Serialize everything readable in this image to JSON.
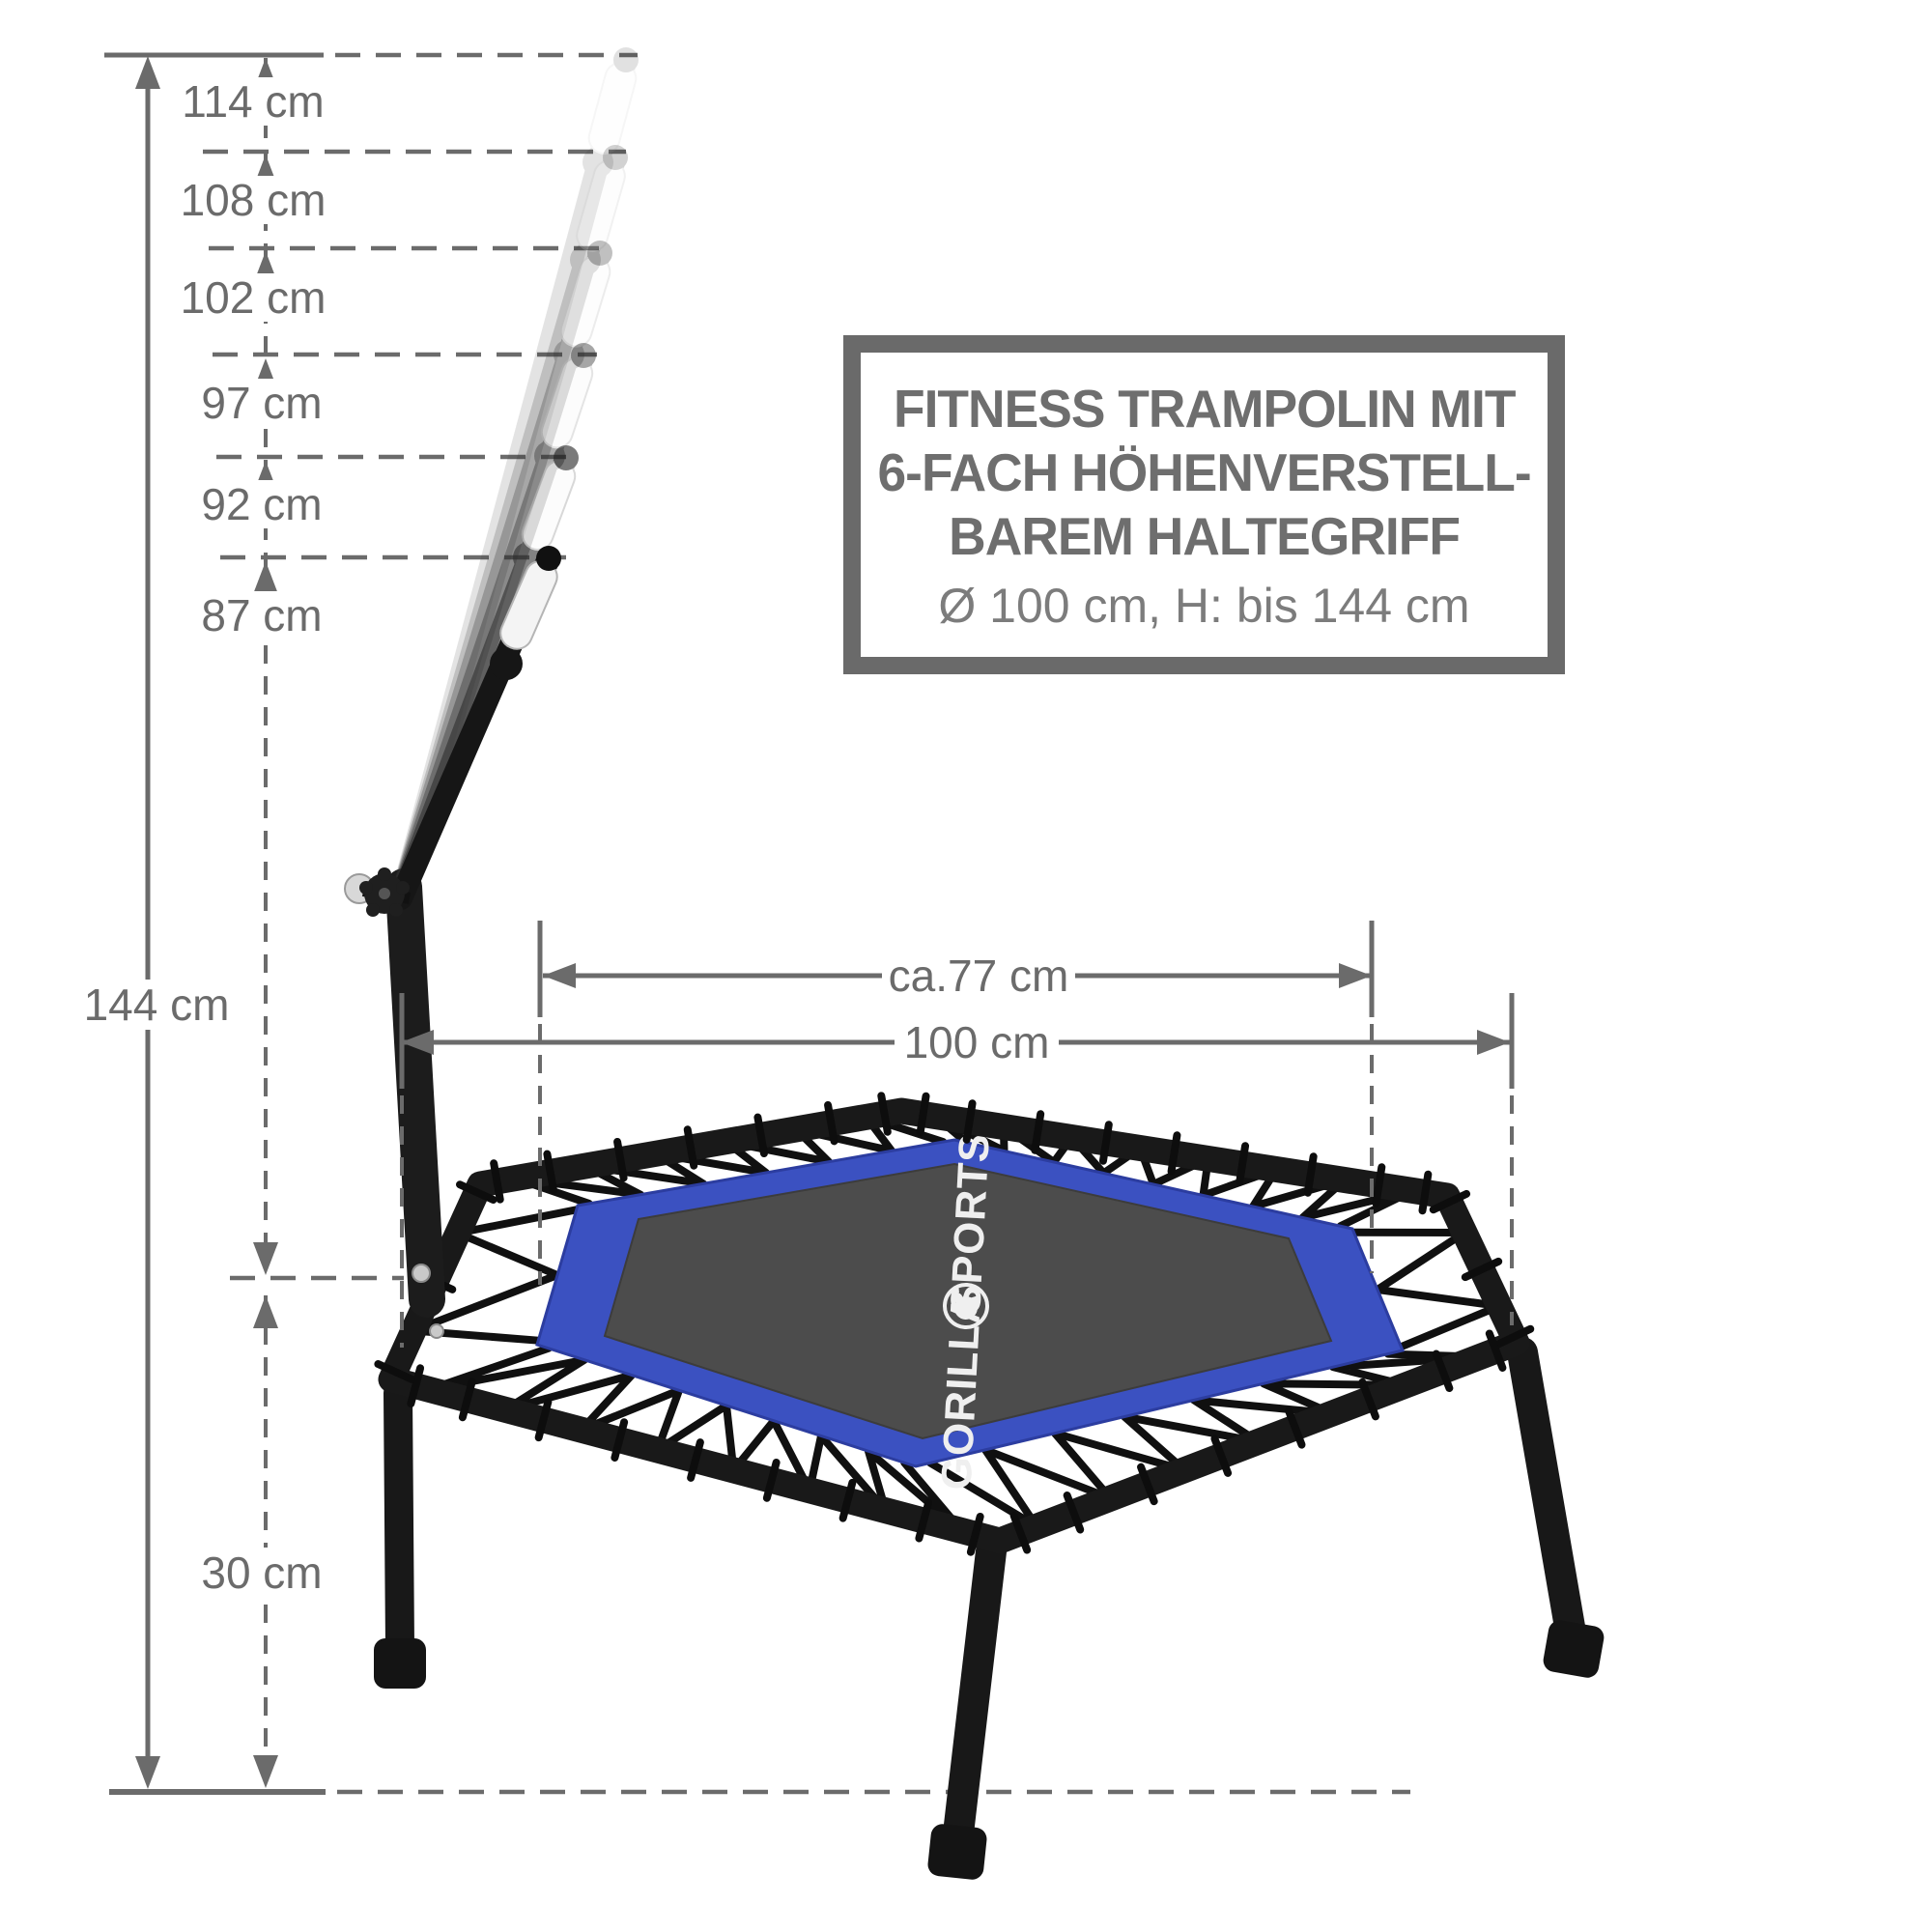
{
  "title_box": {
    "line1": "FITNESS TRAMPOLIN MIT",
    "line2": "6-FACH HÖHENVERSTELL-",
    "line3": "BAREM HALTEGRIFF",
    "subtitle": "Ø 100 cm, H: bis 144 cm"
  },
  "dimensions": {
    "handle_heights": [
      {
        "label": "114 cm",
        "value_cm": 114
      },
      {
        "label": "108 cm",
        "value_cm": 108
      },
      {
        "label": "102 cm",
        "value_cm": 102
      },
      {
        "label": "97 cm",
        "value_cm": 97
      },
      {
        "label": "92 cm",
        "value_cm": 92
      },
      {
        "label": "87 cm",
        "value_cm": 87
      }
    ],
    "total_height": {
      "label": "144 cm",
      "value_cm": 144
    },
    "frame_height": {
      "label": "30 cm",
      "value_cm": 30
    },
    "mat_width": {
      "label": "ca.77 cm",
      "value_cm": 77
    },
    "frame_width": {
      "label": "100 cm",
      "value_cm": 100
    }
  },
  "logo": {
    "word_bottom": "GORILLA",
    "word_top": "SPORTS"
  },
  "colors": {
    "dimension_gray": "#6b6b6b",
    "title_gray": "#6e6e6e",
    "subtitle_gray": "#7c7c7c",
    "border_blue": "#3b51c1",
    "mat_gray": "#4c4c4c",
    "frame_black": "#191919"
  }
}
